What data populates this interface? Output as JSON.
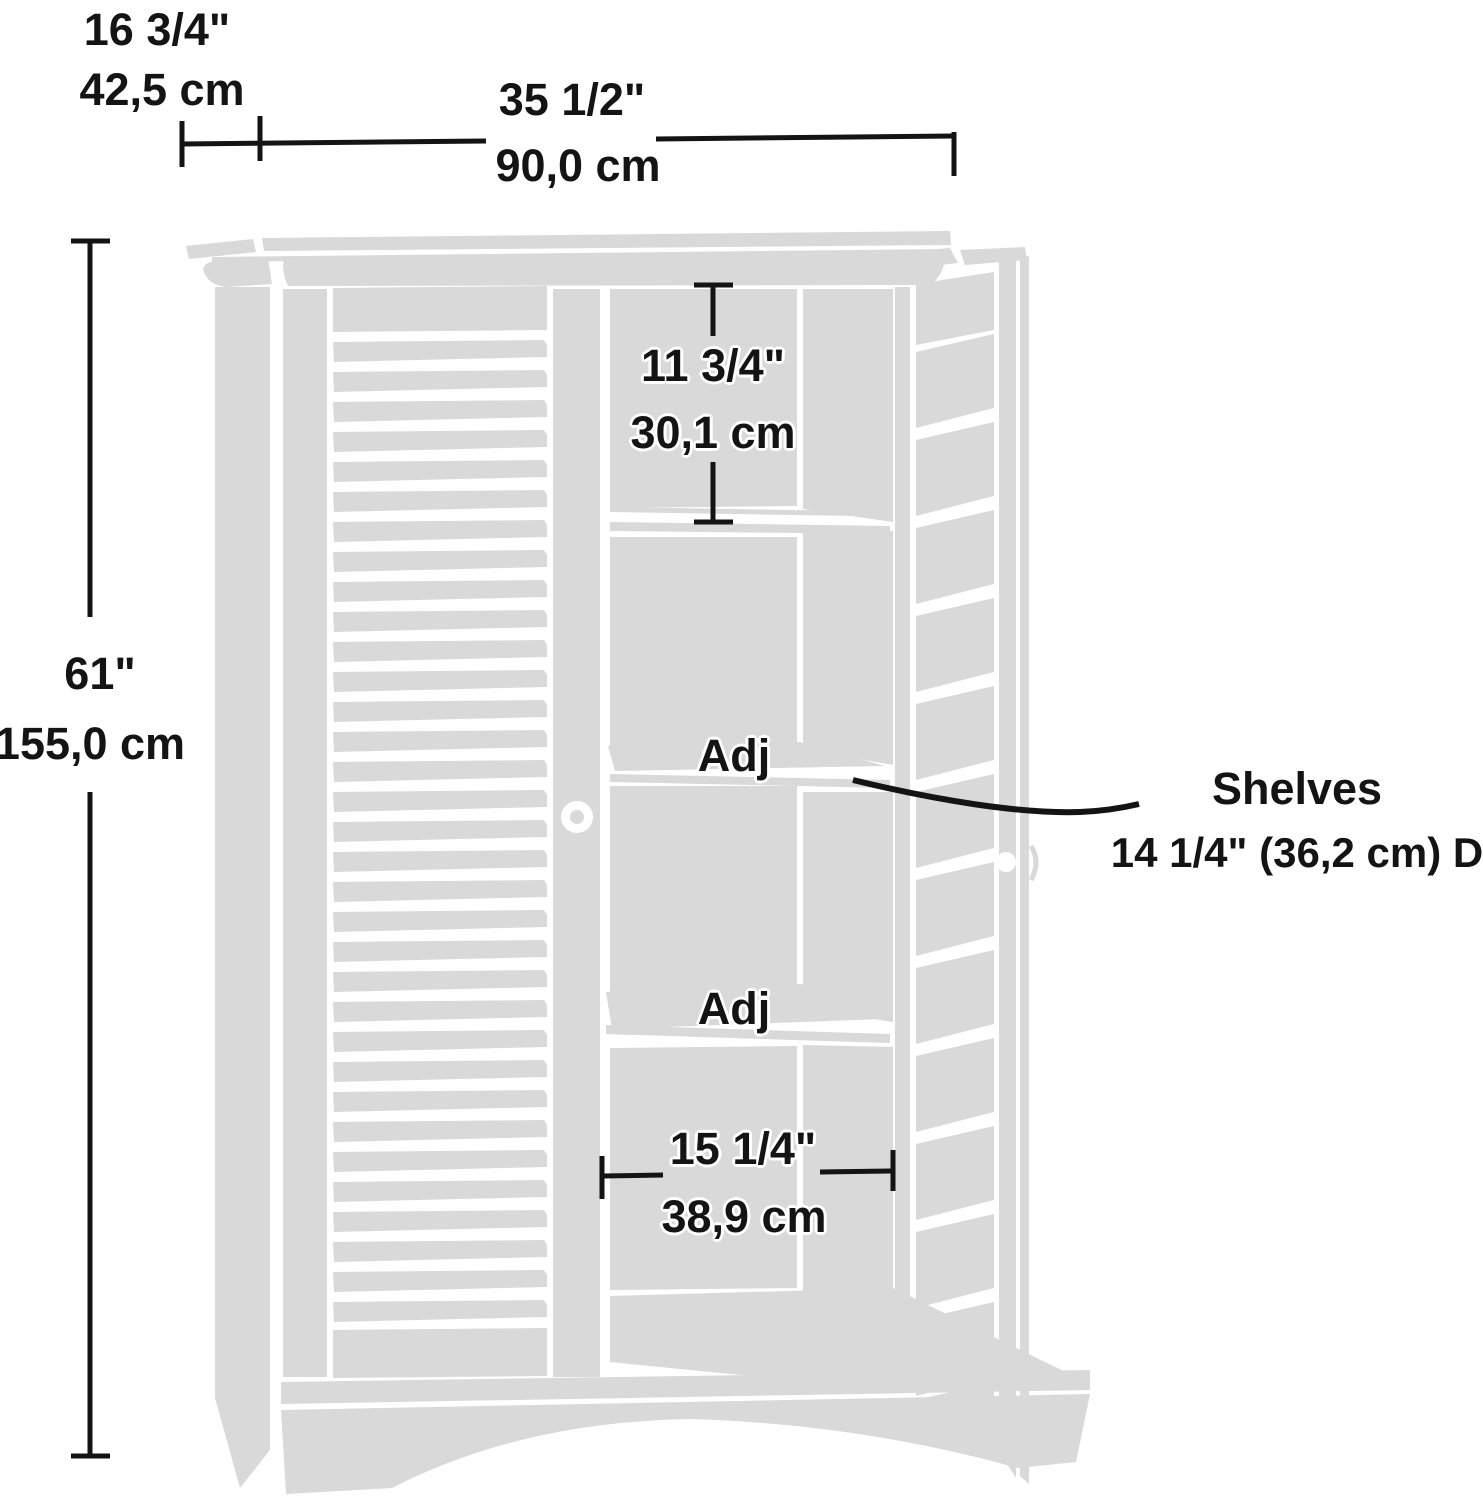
{
  "diagram": {
    "type": "furniture-dimension-diagram",
    "subject": "two-door louvered storage cabinet, right door open",
    "colors": {
      "body_fill": "#d9d9d9",
      "annotation": "#141414",
      "background": "#ffffff"
    },
    "labels": {
      "depth_in": "16 3/4\"",
      "depth_cm": "42,5 cm",
      "width_in": "35 1/2\"",
      "width_cm": "90,0 cm",
      "height_in": "61\"",
      "height_cm": "155,0 cm",
      "top_section_in": "11 3/4\"",
      "top_section_cm": "30,1 cm",
      "adj_shelf_upper": "Adj",
      "adj_shelf_lower": "Adj",
      "inner_width_in": "15 1/4\"",
      "inner_width_cm": "38,9 cm",
      "shelves_title": "Shelves",
      "shelves_depth": "14 1/4\" (36,2 cm) D"
    }
  }
}
